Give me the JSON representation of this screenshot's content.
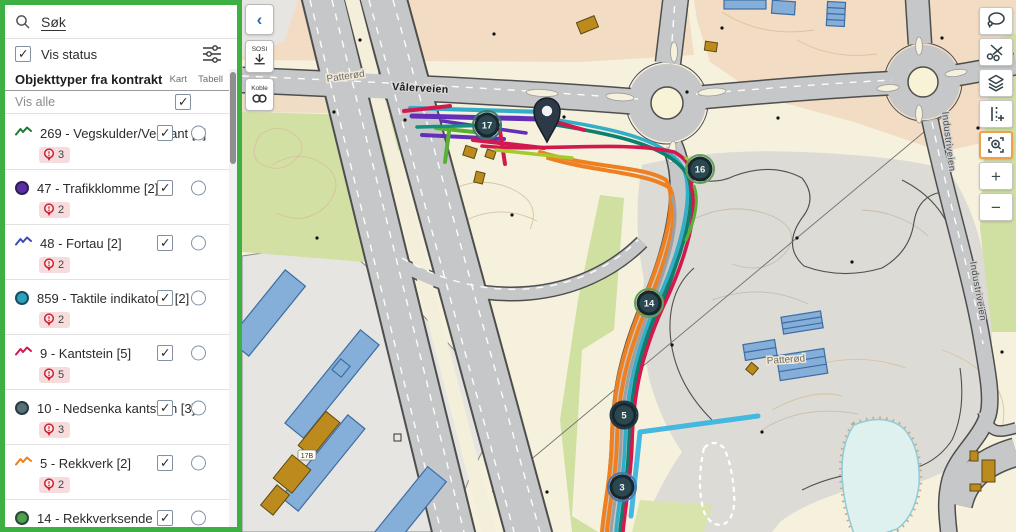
{
  "app": {
    "accent_green": "#3cb043"
  },
  "sidebar": {
    "search": {
      "placeholder": "Søk"
    },
    "status_filter": {
      "label": "Vis status",
      "checked": true
    },
    "list_header": {
      "title": "Objekttyper fra kontrakt",
      "col_map": "Kart",
      "col_table": "Tabell"
    },
    "show_all_label": "Vis alle",
    "items": [
      {
        "label": "269 - Vegskulder/Vegkant [3]",
        "icon": "polyline",
        "color": "#1f7a33",
        "badge": "3",
        "map_checked": true,
        "table_selected": false
      },
      {
        "label": "47 - Trafikklomme [2]",
        "icon": "point",
        "color": "#5e2ea6",
        "badge": "2",
        "map_checked": true,
        "table_selected": false
      },
      {
        "label": "48 - Fortau [2]",
        "icon": "polyline",
        "color": "#3d4db7",
        "badge": "2",
        "map_checked": true,
        "table_selected": false
      },
      {
        "label": "859 - Taktile indikatorer [2]",
        "icon": "point",
        "color": "#2ba3bd",
        "badge": "2",
        "map_checked": true,
        "table_selected": false
      },
      {
        "label": "9 - Kantstein [5]",
        "icon": "polyline",
        "color": "#d2194f",
        "badge": "5",
        "map_checked": true,
        "table_selected": false
      },
      {
        "label": "10 - Nedsenka kantstein [3]",
        "icon": "point",
        "color": "#5a7078",
        "badge": "3",
        "map_checked": true,
        "table_selected": false
      },
      {
        "label": "5 - Rekkverk [2]",
        "icon": "polyline",
        "color": "#ee8022",
        "badge": "2",
        "map_checked": true,
        "table_selected": false
      },
      {
        "label": "14 - Rekkverksende [2]",
        "icon": "point",
        "color": "#4f9e51",
        "badge": null,
        "map_checked": true,
        "table_selected": false
      }
    ]
  },
  "map": {
    "buttons": {
      "collapse": "‹",
      "sosi": "SOSI",
      "koble": "Koble"
    },
    "labels": {
      "road_main": "Vålerveien",
      "place_top": "Patterød",
      "place_bottom": "Patterød",
      "road_right": "Industriveien",
      "building": "17B"
    },
    "markers": [
      {
        "value": "17"
      },
      {
        "value": "16"
      },
      {
        "value": "14"
      },
      {
        "value": "5"
      },
      {
        "value": "3"
      }
    ],
    "route_colors": {
      "orange": "#ee8022",
      "teal": "#0e7f6c",
      "cyan": "#33aec9",
      "crimson": "#d2194f",
      "purple": "#6230b8",
      "green": "#57b135",
      "light_blue": "#45b8e0"
    }
  },
  "toolbar": {
    "buttons": [
      {
        "name": "lasso-select"
      },
      {
        "name": "cut"
      },
      {
        "name": "layers"
      },
      {
        "name": "measure"
      },
      {
        "name": "zoom-to-area",
        "active": true
      },
      {
        "name": "zoom-in",
        "glyph": "+"
      },
      {
        "name": "zoom-out",
        "glyph": "−"
      }
    ]
  }
}
